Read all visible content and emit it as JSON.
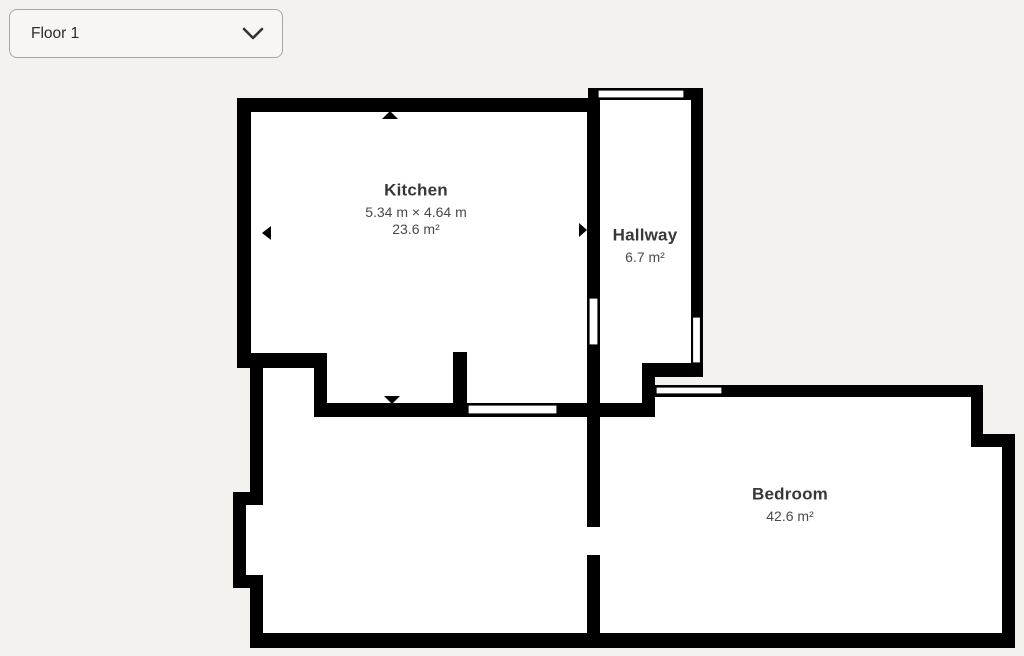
{
  "theme": {
    "background": "#f4f2ef",
    "wall_color": "#000000",
    "room_fill": "#ffffff",
    "opening_fill": "#ffffff",
    "opening_stroke": "#000000"
  },
  "floor_selector": {
    "value": "Floor 1",
    "icon": "chevron-down"
  },
  "rooms": [
    {
      "id": "kitchen",
      "name": "Kitchen",
      "dimensions": "5.34 m × 4.64 m",
      "area": "23.6 m²"
    },
    {
      "id": "hallway",
      "name": "Hallway",
      "area": "6.7 m²"
    },
    {
      "id": "bedroom",
      "name": "Bedroom",
      "area": "42.6 m²"
    }
  ],
  "floorplan": {
    "interiors": [
      {
        "name": "kitchen-interior",
        "points": "251,112 587,112 587,403 327,403 327,353 251,353"
      },
      {
        "name": "hallway-interior",
        "points": "600,100 691,100 691,363 655,363 655,403 600,403"
      },
      {
        "name": "bottom-left-room-interior",
        "points": "263,368 314,368 314,417 587,417 587,633 263,633 263,575 246,575 246,505 263,505"
      },
      {
        "name": "bedroom-interior",
        "points": "600,417 655,417 655,397 971,397 971,447 1002,447 1002,633 600,633"
      }
    ],
    "walls": [
      {
        "name": "kitchen-top-wall",
        "x": 237,
        "y": 98,
        "w": 363,
        "h": 14
      },
      {
        "name": "kitchen-left-wall",
        "x": 237,
        "y": 98,
        "w": 14,
        "h": 270
      },
      {
        "name": "kitchen-bottom-left-wall",
        "x": 237,
        "y": 353,
        "w": 90,
        "h": 15
      },
      {
        "name": "kitchen-step-wall",
        "x": 314,
        "y": 353,
        "w": 13,
        "h": 64
      },
      {
        "name": "kitchen-bottom-wall",
        "x": 314,
        "y": 403,
        "w": 341,
        "h": 14
      },
      {
        "name": "kitchen-right-wall",
        "x": 587,
        "y": 98,
        "w": 13,
        "h": 319
      },
      {
        "name": "kitchen-stub-wall",
        "x": 453,
        "y": 352,
        "w": 14,
        "h": 61
      },
      {
        "name": "hallway-top-wall",
        "x": 588,
        "y": 88,
        "w": 115,
        "h": 12
      },
      {
        "name": "hallway-right-wall",
        "x": 691,
        "y": 88,
        "w": 12,
        "h": 289
      },
      {
        "name": "hallway-bottom-wall",
        "x": 642,
        "y": 363,
        "w": 61,
        "h": 14
      },
      {
        "name": "hallway-step-wall",
        "x": 642,
        "y": 363,
        "w": 13,
        "h": 54
      },
      {
        "name": "bedroom-top-wall",
        "x": 654,
        "y": 385,
        "w": 329,
        "h": 12
      },
      {
        "name": "bedroom-right-upper-wall",
        "x": 971,
        "y": 385,
        "w": 12,
        "h": 62
      },
      {
        "name": "bedroom-step-wall",
        "x": 971,
        "y": 434,
        "w": 44,
        "h": 13
      },
      {
        "name": "bedroom-right-lower-wall",
        "x": 1002,
        "y": 434,
        "w": 13,
        "h": 214
      },
      {
        "name": "bottom-outer-wall",
        "x": 250,
        "y": 633,
        "w": 765,
        "h": 15
      },
      {
        "name": "divider-wall-upper",
        "x": 587,
        "y": 417,
        "w": 13,
        "h": 110
      },
      {
        "name": "divider-wall-lower",
        "x": 587,
        "y": 555,
        "w": 13,
        "h": 78
      },
      {
        "name": "left-wall-upper",
        "x": 250,
        "y": 360,
        "w": 13,
        "h": 140
      },
      {
        "name": "alcove-top-wall",
        "x": 233,
        "y": 492,
        "w": 30,
        "h": 13
      },
      {
        "name": "alcove-left-wall",
        "x": 233,
        "y": 492,
        "w": 13,
        "h": 96
      },
      {
        "name": "alcove-bottom-wall",
        "x": 233,
        "y": 575,
        "w": 30,
        "h": 13
      },
      {
        "name": "left-wall-lower",
        "x": 250,
        "y": 575,
        "w": 13,
        "h": 73
      }
    ],
    "passages": [
      {
        "name": "divider-door-gap",
        "x": 587,
        "y": 527,
        "w": 13,
        "h": 28
      }
    ],
    "openings": [
      {
        "name": "hallway-top-window",
        "x": 598,
        "y": 90,
        "w": 86,
        "h": 8
      },
      {
        "name": "hallway-right-window",
        "x": 692.5,
        "y": 317,
        "w": 8,
        "h": 46
      },
      {
        "name": "kitchen-hallway-door",
        "x": 589,
        "y": 298,
        "w": 9,
        "h": 47
      },
      {
        "name": "kitchen-bottom-window",
        "x": 468,
        "y": 405,
        "w": 89,
        "h": 9
      },
      {
        "name": "bedroom-top-window",
        "x": 656,
        "y": 387,
        "w": 66,
        "h": 7
      }
    ],
    "arrows": [
      {
        "name": "measure-arrow-up",
        "points": "382,119 398,119 390,111"
      },
      {
        "name": "measure-arrow-down",
        "points": "384,396 400,396 392,404"
      },
      {
        "name": "measure-arrow-left",
        "points": "271,226 271,240 262,233"
      },
      {
        "name": "measure-arrow-right",
        "points": "579,223 579,237 587,230"
      }
    ]
  }
}
